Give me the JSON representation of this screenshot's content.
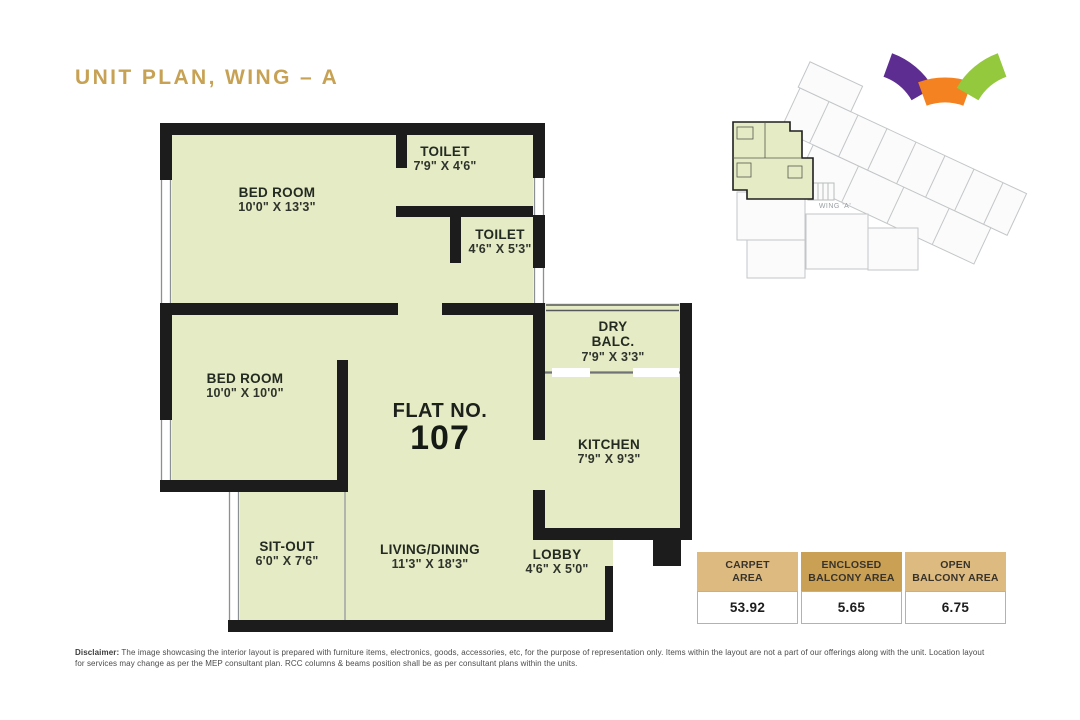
{
  "page": {
    "title": "UNIT PLAN, WING – A"
  },
  "colors": {
    "title_gold": "#c7a254",
    "plan_fill": "#e5ebc4",
    "wall": "#1c1c1c",
    "window_line": "#8b9094",
    "keyplan_gray": "#c3c6c8",
    "table_header_light": "#ddba7f",
    "table_header_dark": "#c9a054"
  },
  "plan": {
    "flat_label": "FLAT NO.",
    "flat_number": "107",
    "rooms": {
      "bedroom1": {
        "name": "BED ROOM",
        "dim": "10'0\" X 13'3\""
      },
      "toilet1": {
        "name": "TOILET",
        "dim": "7'9\" X 4'6\""
      },
      "toilet2": {
        "name": "TOILET",
        "dim": "4'6\" X 5'3\""
      },
      "bedroom2": {
        "name": "BED ROOM",
        "dim": "10'0\" X 10'0\""
      },
      "drybalc": {
        "name": "DRY",
        "name2": "BALC.",
        "dim": "7'9\" X 3'3\""
      },
      "kitchen": {
        "name": "KITCHEN",
        "dim": "7'9\" X 9'3\""
      },
      "sitout": {
        "name": "SIT-OUT",
        "dim": "6'0\" X 7'6\""
      },
      "living": {
        "name": "LIVING/DINING",
        "dim": "11'3\" X 18'3\""
      },
      "lobby": {
        "name": "LOBBY",
        "dim": "4'6\" X 5'0\""
      }
    }
  },
  "keyplan": {
    "wing_label": "WING 'A'",
    "arc_colors": {
      "purple": "#5e2d91",
      "orange": "#f58220",
      "green": "#94c83d"
    }
  },
  "areas_table": {
    "columns": [
      {
        "h1": "CARPET",
        "h2": "AREA",
        "value": "53.92"
      },
      {
        "h1": "ENCLOSED",
        "h2": "BALCONY AREA",
        "value": "5.65"
      },
      {
        "h1": "OPEN",
        "h2": "BALCONY AREA",
        "value": "6.75"
      }
    ]
  },
  "disclaimer": {
    "label": "Disclaimer:",
    "text": "The image showcasing the interior layout is prepared with furniture items, electronics, goods, accessories, etc, for the purpose of representation only. Items within the layout are not a part of our offerings along with the unit. Location layout for services may change as per the MEP consultant plan. RCC columns & beams position shall be as per consultant plans within the units."
  }
}
